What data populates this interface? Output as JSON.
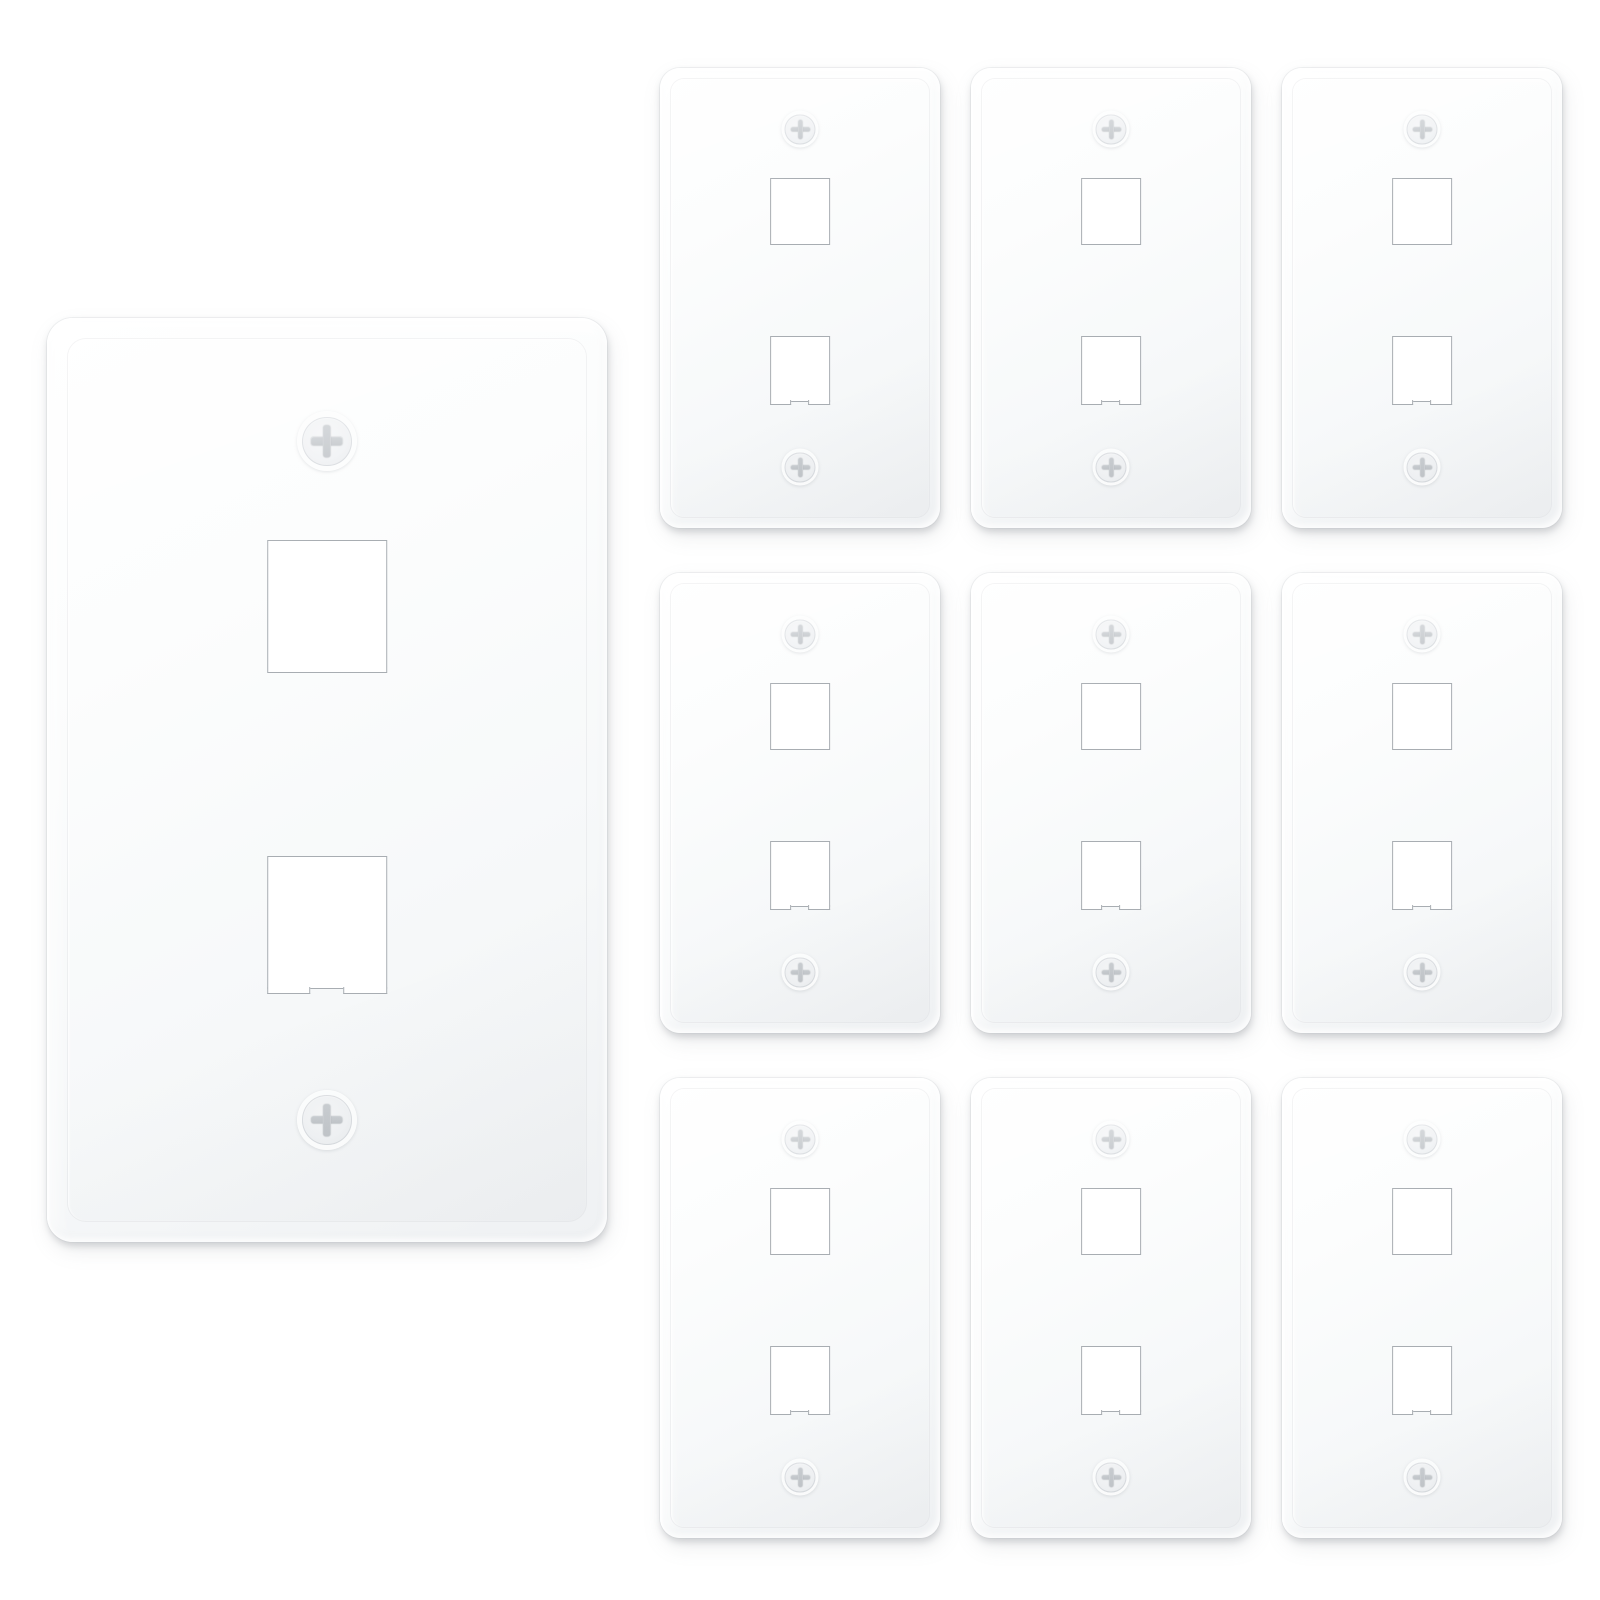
{
  "scene": {
    "type": "product-photo",
    "subject": "white one-gang two-port keystone wall plates",
    "background_color": "#ffffff"
  },
  "hero_plate": {
    "ports": 2,
    "screws": 2,
    "orientation": "vertical"
  },
  "grid": {
    "rows": 3,
    "cols": 3,
    "plate_count": 9,
    "ports_per_plate": 2,
    "screws_per_plate": 2
  },
  "totals": {
    "plates": 10,
    "ports": 20,
    "screws": 20
  },
  "colors": {
    "background": "#ffffff",
    "plate_face": "#f7f8fa",
    "plate_highlight": "#ffffff",
    "plate_shadow": "#c6cacd",
    "port_fill": "#ffffff",
    "port_border": "#a8adb2",
    "screw_head": "#f1f3f5",
    "screw_cross": "#c9cdd1"
  },
  "icons": {
    "screw": "phillips-screw-icon",
    "port": "keystone-port-opening"
  }
}
